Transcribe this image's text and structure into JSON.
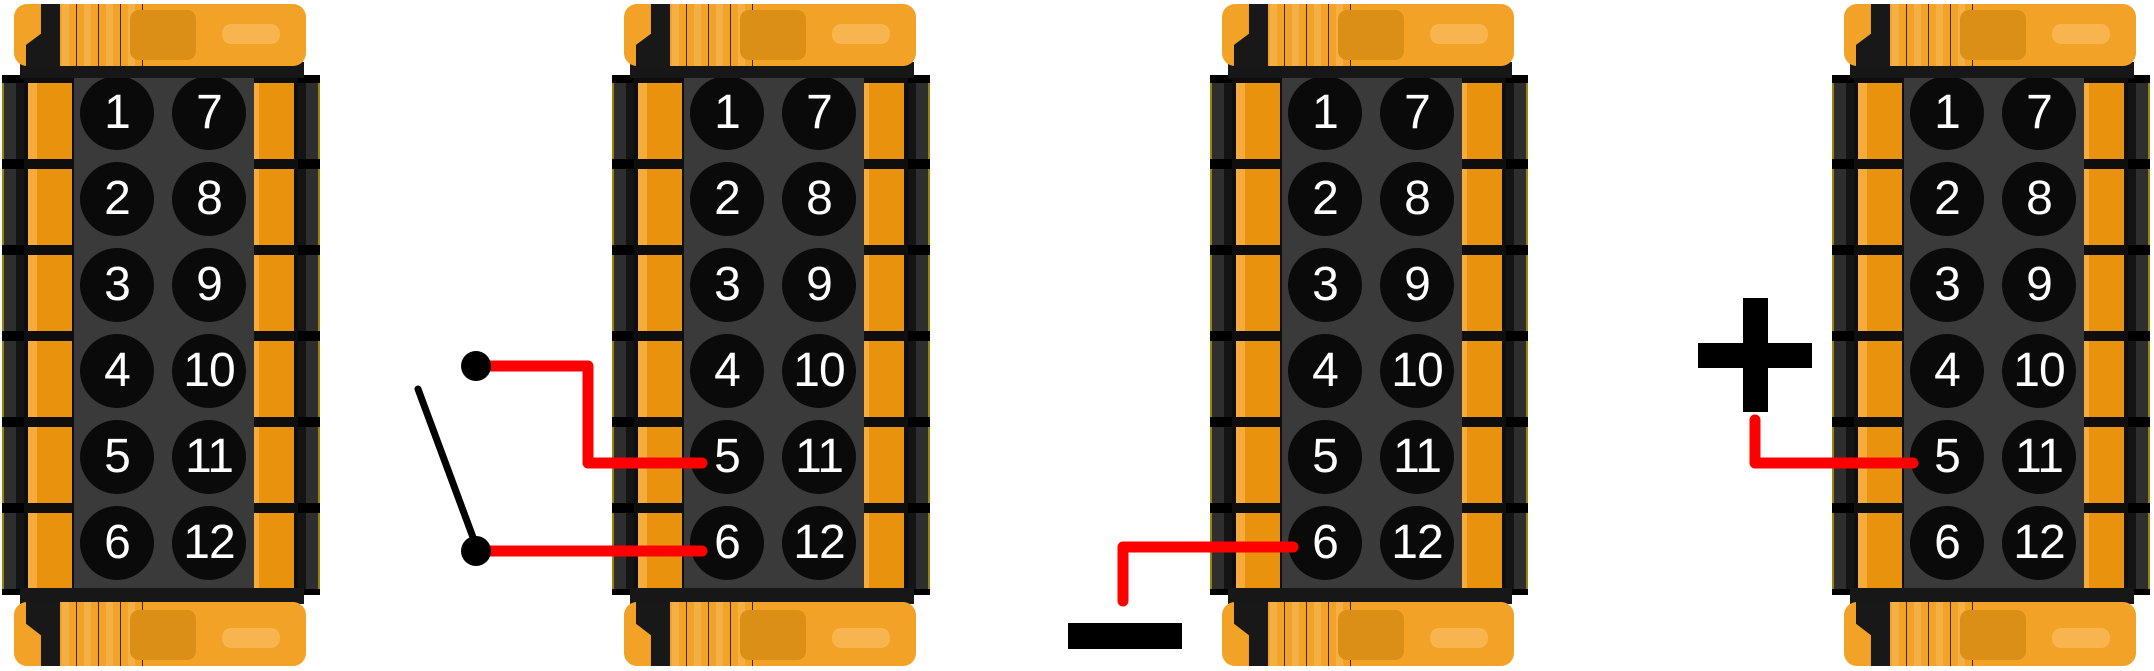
{
  "canvas": {
    "width": 2154,
    "height": 671,
    "background": "#FFFFFF"
  },
  "colors": {
    "housing_orange": "#F2A227",
    "tab_orange": "#E8920E",
    "tab_highlight": "#F5AC3C",
    "latch_orange": "#DC8F17",
    "slot_orange": "#F8B44E",
    "body_gray": "#3A3A3A",
    "edge_gray": "#2E2E2E",
    "edge_outline": "#9A8408",
    "pin_black": "#0A0A0A",
    "pin_number": "#FFFFFF",
    "wire_red": "#FF0000",
    "symbol_black": "#000000"
  },
  "connectors": [
    {
      "name": "connector-1",
      "left_pins": [
        "1",
        "2",
        "3",
        "4",
        "5",
        "6"
      ],
      "right_pins": [
        "7",
        "8",
        "9",
        "10",
        "11",
        "12"
      ]
    },
    {
      "name": "connector-2",
      "left_pins": [
        "1",
        "2",
        "3",
        "4",
        "5",
        "6"
      ],
      "right_pins": [
        "7",
        "8",
        "9",
        "10",
        "11",
        "12"
      ]
    },
    {
      "name": "connector-3",
      "left_pins": [
        "1",
        "2",
        "3",
        "4",
        "5",
        "6"
      ],
      "right_pins": [
        "7",
        "8",
        "9",
        "10",
        "11",
        "12"
      ]
    },
    {
      "name": "connector-4",
      "left_pins": [
        "1",
        "2",
        "3",
        "4",
        "5",
        "6"
      ],
      "right_pins": [
        "7",
        "8",
        "9",
        "10",
        "11",
        "12"
      ]
    }
  ],
  "annotations": {
    "switch": {
      "kind": "open-switch",
      "connects": [
        "connector-2-pin-5",
        "connector-2-pin-6"
      ]
    },
    "negative": {
      "symbol": "−",
      "connects": "connector-3-pin-6"
    },
    "positive": {
      "symbol": "+",
      "connects": "connector-4-pin-5"
    }
  }
}
